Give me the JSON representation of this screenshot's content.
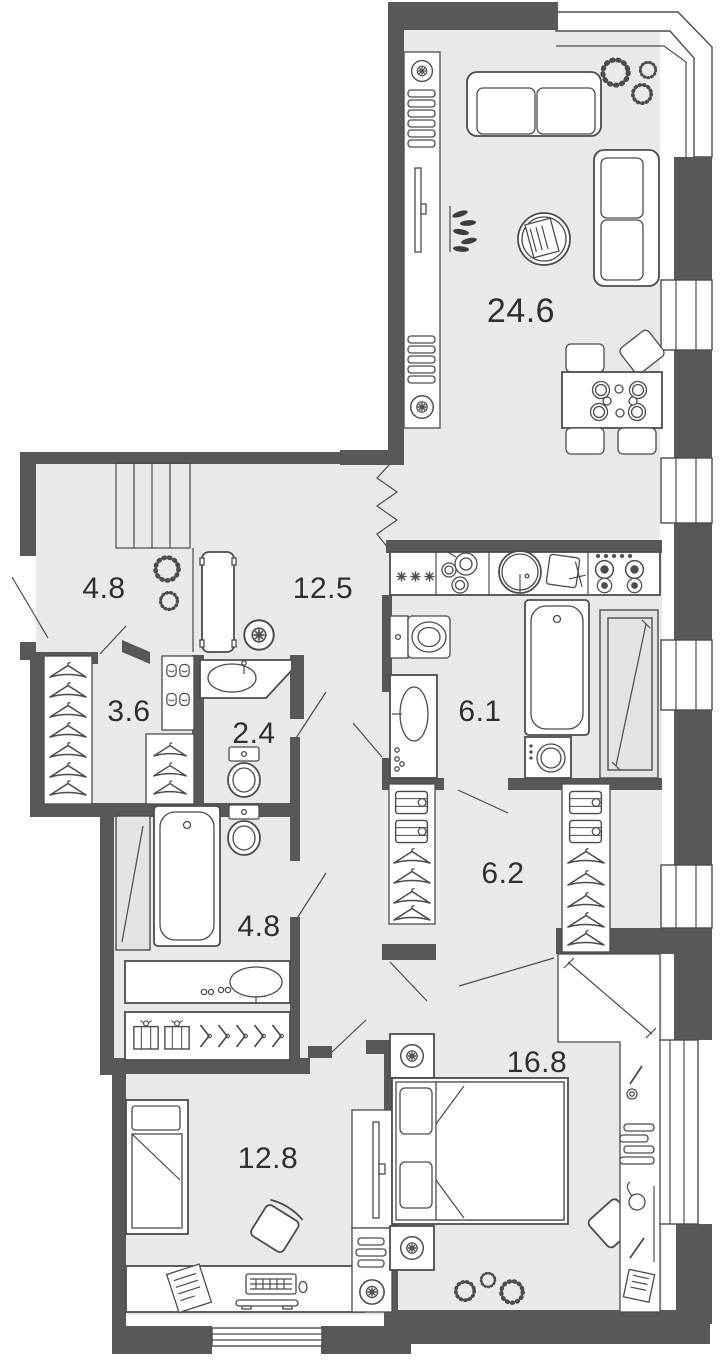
{
  "plan": {
    "type": "apartment-floor-plan",
    "total_rooms": 10,
    "colors": {
      "wall": "#58585a",
      "floor": "#e9e9eb",
      "outline": "#4c4c4e",
      "panel": "#e3e3e5",
      "background": "#ffffff",
      "label_text": "#2f2f31"
    },
    "rooms": [
      {
        "name": "living-room-kitchen",
        "area": "24.6"
      },
      {
        "name": "hallway",
        "area": "12.5"
      },
      {
        "name": "entry-hall",
        "area": "4.8"
      },
      {
        "name": "closet",
        "area": "3.6"
      },
      {
        "name": "wc",
        "area": "2.4"
      },
      {
        "name": "bathroom",
        "area": "6.1"
      },
      {
        "name": "walk-in-closet",
        "area": "6.2"
      },
      {
        "name": "bathroom-2",
        "area": "4.8"
      },
      {
        "name": "bedroom-master",
        "area": "16.8"
      },
      {
        "name": "bedroom-second",
        "area": "12.8"
      }
    ],
    "icons": {
      "hanger": "triangle-hook",
      "ceiling-lamp": "circle-star",
      "plant": "dashed-circle",
      "storage-box": "rect-ribbon",
      "shoe-pair": "double-rect",
      "snowflake": "asterisk",
      "stove-burner": "ring",
      "profile-hanger": "chevron-hook",
      "folded-clothes": "rect-bow"
    }
  }
}
